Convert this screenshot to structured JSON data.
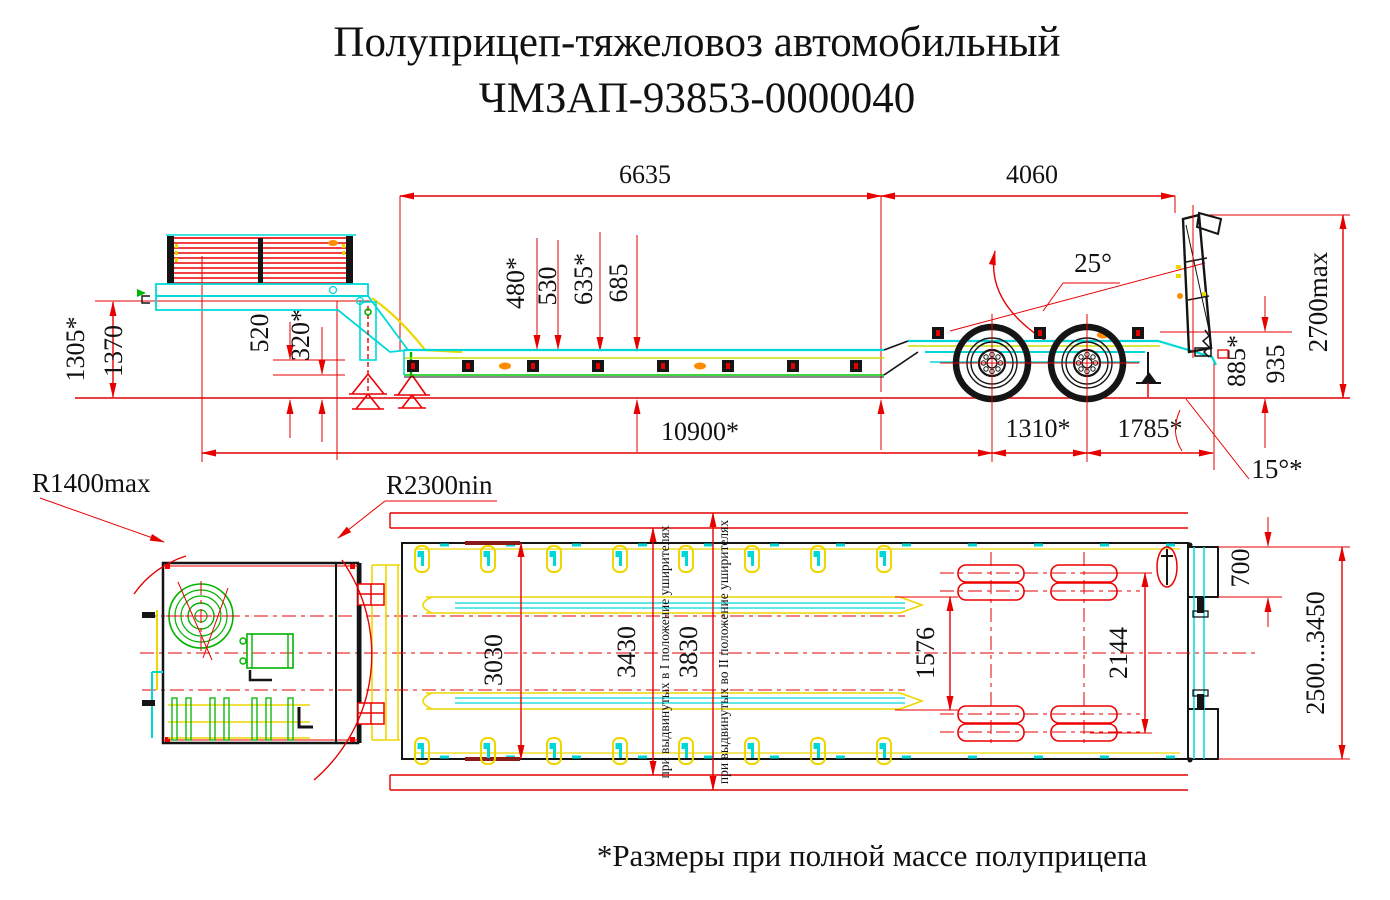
{
  "title": {
    "line1": "Полуприцеп-тяжеловоз автомобильный",
    "line2": "ЧМЗАП-93853-0000040"
  },
  "footnote": "*Размеры при полной массе полуприцепа",
  "side_view": {
    "dims": {
      "deck_length": "6635",
      "rear_length": "4060",
      "overall_height": "2700max",
      "front_height_laden": "1305*",
      "front_height": "1370",
      "gooseneck_clearance": "520",
      "deck_clearance": "320*",
      "deck_height_1": "480*",
      "deck_height_2": "530",
      "deck_height_3": "635*",
      "deck_height_4": "685",
      "kingpin_to_axle": "10900*",
      "axle_base": "1310*",
      "rear_overhang": "1785*",
      "rear_height_laden": "885*",
      "rear_height": "935",
      "gooseneck_angle": "25°",
      "departure_angle": "15°*"
    }
  },
  "plan_view": {
    "dims": {
      "front_radius": "R1400max",
      "rear_radius": "R2300nin",
      "deck_width": "3030",
      "width_pos_1": "3430",
      "width_pos_2": "3830",
      "track_inner": "1576",
      "track_outer": "2144",
      "ramp_width_offset": "700",
      "overall_width": "2500...3450"
    },
    "notes": {
      "pos_1": "при выдвинутых в I положение уширителях",
      "pos_2": "при выдвинутых во II положение уширителях"
    }
  },
  "colors": {
    "dimension": "#e60000",
    "cyan": "#00d8d8",
    "yellow": "#eed600",
    "green": "#00b400",
    "red": "#ee0000",
    "dark": "#141414",
    "orange": "#ff8c00",
    "darkred": "#8b1a1a"
  }
}
